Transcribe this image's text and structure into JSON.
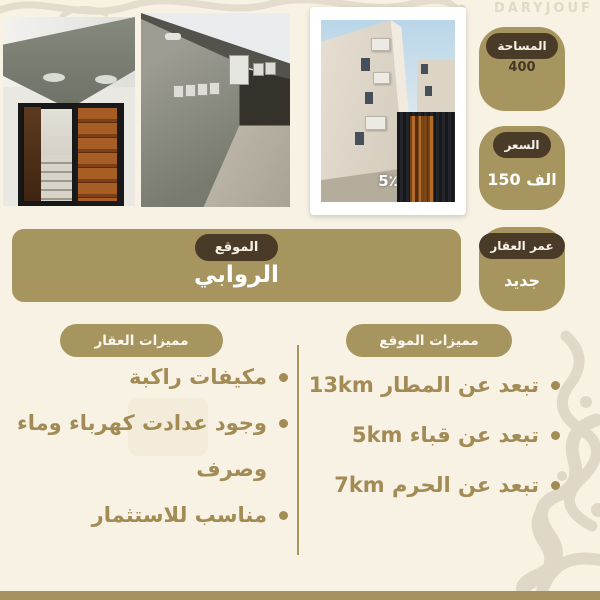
{
  "watermark": {
    "brand": "DARYJOUF"
  },
  "photos": {
    "overlay_label": "5٪"
  },
  "badges": [
    {
      "label": "المساحة",
      "value": "400"
    },
    {
      "label": "السعر",
      "value": "الف 150"
    },
    {
      "label": "عمر العقار",
      "value": "جديد"
    }
  ],
  "location": {
    "label": "الموقع",
    "value": "الروابي"
  },
  "property_features": {
    "title": "مميزات العقار",
    "items": [
      "مكيفات راكبة",
      "وجود عدادت كهرباء وماء وصرف",
      "مناسب للاستثمار"
    ]
  },
  "location_features": {
    "title": "مميزات الموقع",
    "items": [
      "تبعد عن المطار 13km",
      "تبعد عن قباء 5km",
      "تبعد عن الحرم 7km"
    ]
  },
  "colors": {
    "background": "#f8f2e4",
    "tan": "#a79560",
    "dark_brown": "#4a3a28",
    "feature_text": "#a28b55",
    "white_text": "#ffffff"
  }
}
